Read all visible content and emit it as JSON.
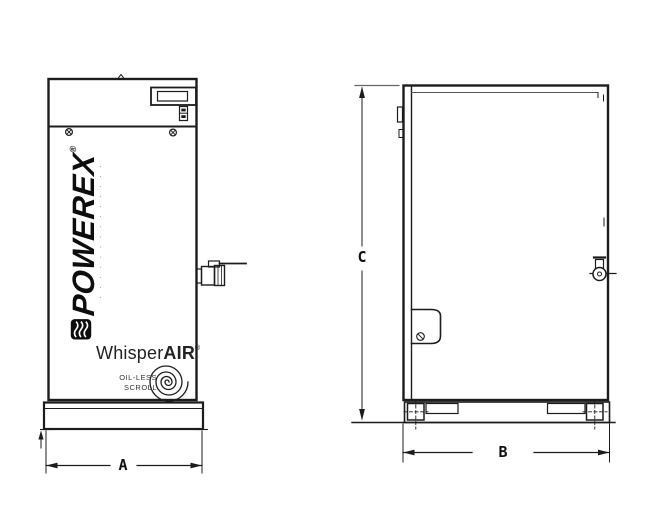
{
  "colors": {
    "background": "#ffffff",
    "line": "#1c1c1c",
    "thin_line": "#555555"
  },
  "front_view": {
    "powerex_logo": {
      "text": "POWEREX",
      "registered_mark": "®",
      "tagline_dots": "· · · · · · · · · · · · · ·"
    },
    "whisper_air_logo": {
      "whisper": "Whisper",
      "air": "AIR",
      "registered_mark": "®",
      "subtitle_line_1": "OIL-LESS",
      "subtitle_line_2": "SCROLL"
    },
    "width_dimension_label": "A"
  },
  "side_view": {
    "depth_dimension_label": "B",
    "height_dimension_label": "C"
  }
}
